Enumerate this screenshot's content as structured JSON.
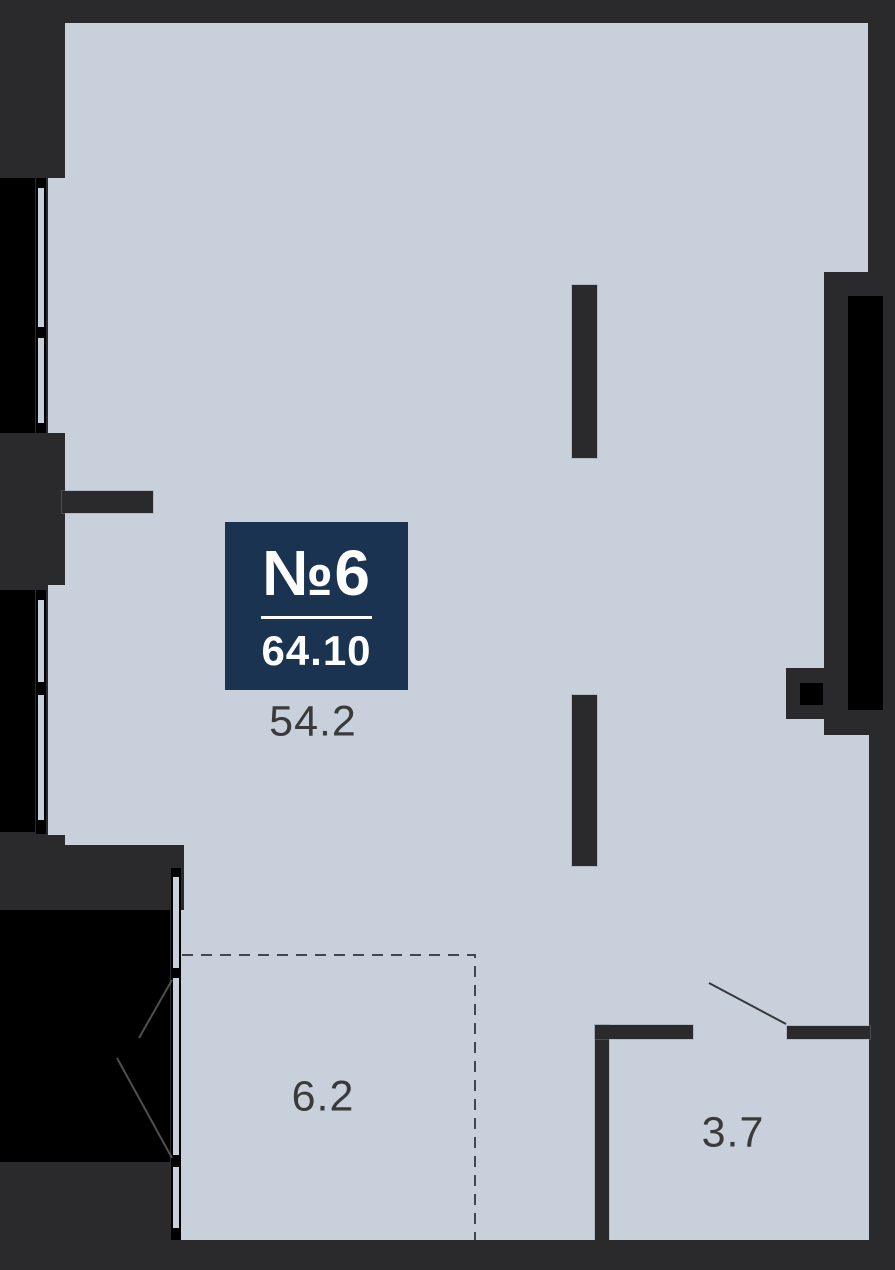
{
  "plan": {
    "badge": {
      "number": "№6",
      "area": "64.10"
    },
    "rooms": {
      "main": {
        "label": "54.2"
      },
      "zone": {
        "label": "6.2"
      },
      "bath": {
        "label": "3.7"
      }
    },
    "colors": {
      "background_wall": "#2a2a2c",
      "floor": "#c8d1db",
      "badge": "#1a3350",
      "badge_text": "#ffffff",
      "area_label_text": "#3a3a3a",
      "window": "#000000",
      "dashed_zone_line": "#46464a"
    }
  }
}
